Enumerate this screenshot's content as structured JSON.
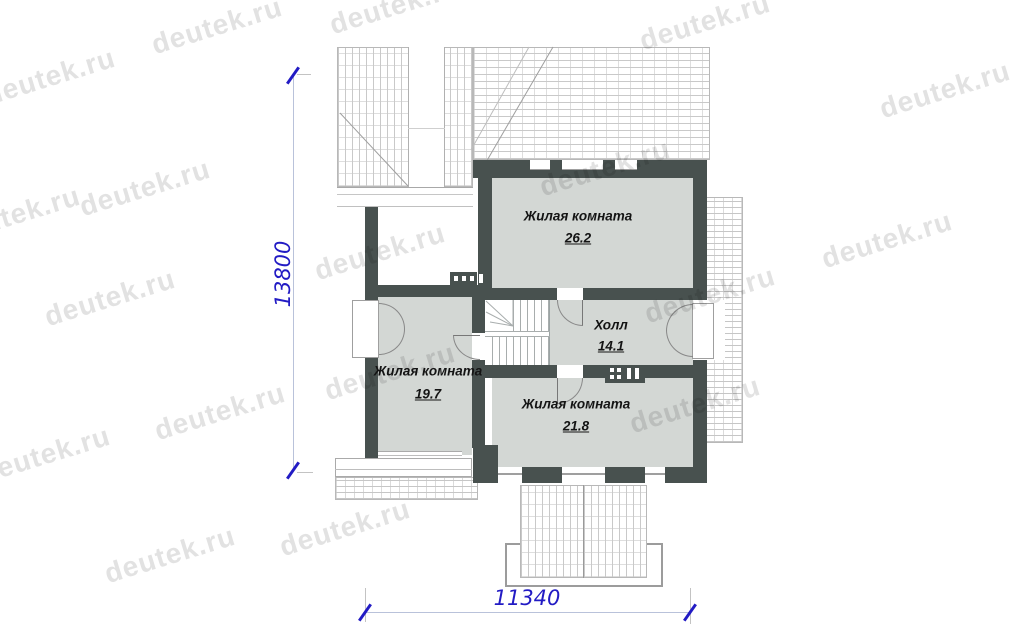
{
  "watermark": {
    "text": "deutek.ru"
  },
  "rooms": [
    {
      "id": "living-top",
      "name": "Жилая комната",
      "area": "26.2"
    },
    {
      "id": "living-left",
      "name": "Жилая комната",
      "area": "19.7"
    },
    {
      "id": "hall",
      "name": "Холл",
      "area": "14.1"
    },
    {
      "id": "living-bottom",
      "name": "Жилая комната",
      "area": "21.8"
    }
  ],
  "dimensions": {
    "width": "11340",
    "height": "13800"
  },
  "colors": {
    "wall": "#48514f",
    "fill": "#d3d7d4",
    "dim": "#221bc4",
    "dimline": "#b9c2da",
    "watermark": "#e2e2e2"
  }
}
